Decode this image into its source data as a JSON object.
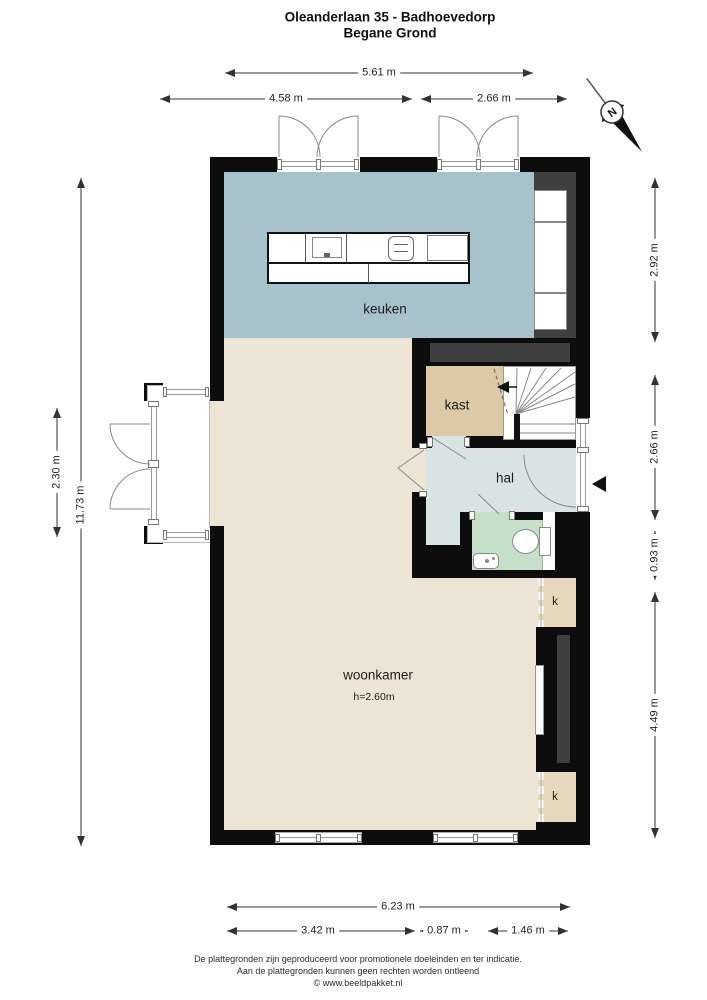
{
  "title": {
    "line1": "Oleanderlaan 35 - Badhoevedorp",
    "line2": "Begane Grond"
  },
  "compass": {
    "label": "N"
  },
  "rooms": {
    "keuken": "keuken",
    "kast": "kast",
    "hal": "hal",
    "woonkamer": "woonkamer",
    "woonkamer_height": "h=2.60m",
    "k_top": "k",
    "k_bottom": "k"
  },
  "dimensions": {
    "top": [
      "5.61 m",
      "4.58 m",
      "2.66 m"
    ],
    "left": [
      "11.73 m",
      "2.30 m"
    ],
    "right": [
      "2.92 m",
      "2.66 m",
      "0.93 m",
      "4.49 m"
    ],
    "bottom": [
      "6.23 m",
      "3.42 m",
      "0.87 m",
      "1.46 m"
    ]
  },
  "footer": {
    "line1": "De plattegronden zijn geproduceerd voor promotionele doeleinden en ter indicatie.",
    "line2": "Aan de plattegronden kunnen geen rechten worden ontleend",
    "line3": "© www.beeldpakket.nl"
  },
  "colors": {
    "wall": "#0d0d0d",
    "inset": "#3f3f3f",
    "keuken": "#a7c2cb",
    "woonkamer": "#ede4d6",
    "kast": "#dcc9a5",
    "nook": "#e6d8bd",
    "hal": "#d8e3e3",
    "toilet": "#c6dfc9",
    "line": "#333333"
  }
}
